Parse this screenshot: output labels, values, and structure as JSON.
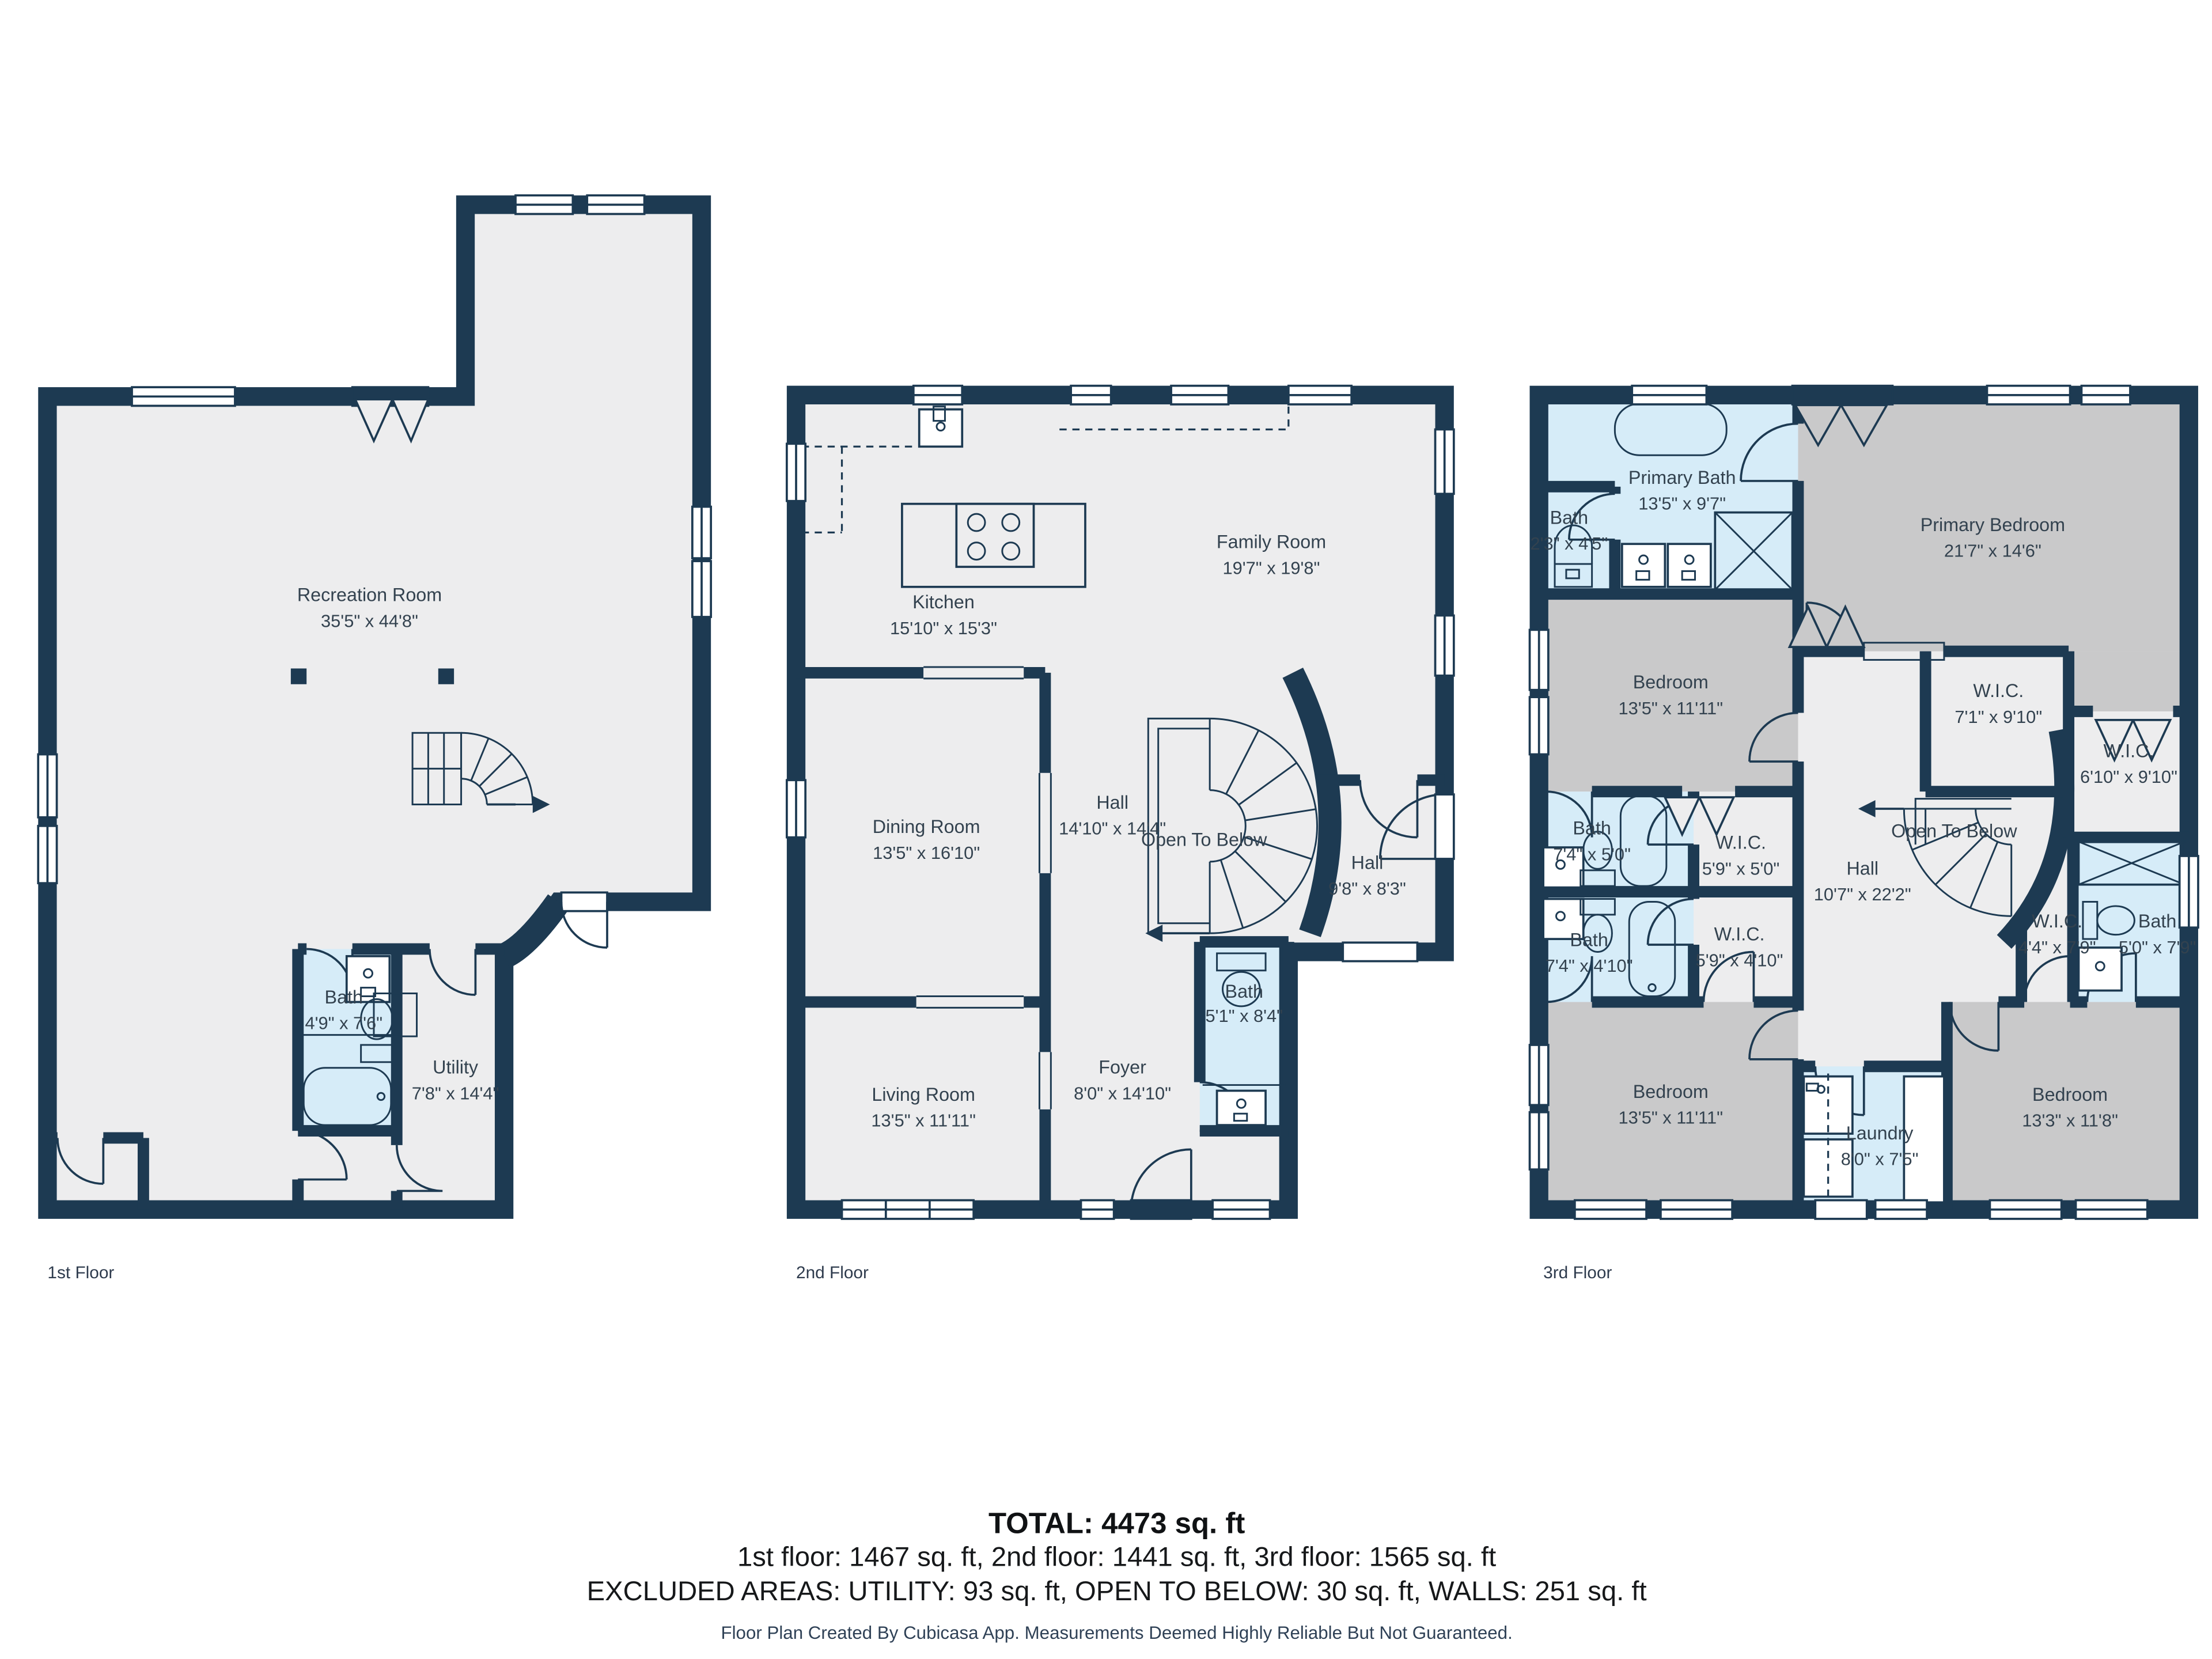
{
  "colors": {
    "wall": "#1d3a52",
    "room_default": "#ededee",
    "room_bedroom": "#c9c9ca",
    "room_wet": "#d6ecf8",
    "label_text": "#33424f",
    "background": "#ffffff"
  },
  "floors": [
    {
      "label": "1st Floor",
      "rooms": [
        {
          "name": "Recreation Room",
          "dims": "35'5\" x 44'8\""
        },
        {
          "name": "Bath",
          "dims": "4'9\" x 7'6\""
        },
        {
          "name": "Utility",
          "dims": "7'8\" x 14'4\""
        }
      ]
    },
    {
      "label": "2nd Floor",
      "rooms": [
        {
          "name": "Kitchen",
          "dims": "15'10\" x 15'3\""
        },
        {
          "name": "Family Room",
          "dims": "19'7\" x 19'8\""
        },
        {
          "name": "Dining Room",
          "dims": "13'5\" x 16'10\""
        },
        {
          "name": "Hall",
          "dims": "14'10\" x 14'4\""
        },
        {
          "name": "Open To Below",
          "dims": ""
        },
        {
          "name": "Hall",
          "dims": "9'8\" x 8'3\""
        },
        {
          "name": "Bath",
          "dims": "5'1\" x 8'4\""
        },
        {
          "name": "Foyer",
          "dims": "8'0\" x 14'10\""
        },
        {
          "name": "Living Room",
          "dims": "13'5\" x 11'11\""
        }
      ]
    },
    {
      "label": "3rd Floor",
      "rooms": [
        {
          "name": "Primary Bath",
          "dims": "13'5\" x 9'7\""
        },
        {
          "name": "Bath",
          "dims": "2'3\" x 4'5\""
        },
        {
          "name": "Primary Bedroom",
          "dims": "21'7\" x 14'6\""
        },
        {
          "name": "Bedroom",
          "dims": "13'5\" x 11'11\""
        },
        {
          "name": "W.I.C.",
          "dims": "7'1\" x 9'10\""
        },
        {
          "name": "W.I.C.",
          "dims": "6'10\" x 9'10\""
        },
        {
          "name": "Bath",
          "dims": "7'4\" x 5'0\""
        },
        {
          "name": "W.I.C.",
          "dims": "5'9\" x 5'0\""
        },
        {
          "name": "Bath",
          "dims": "7'4\" x 4'10\""
        },
        {
          "name": "W.I.C.",
          "dims": "5'9\" x 4'10\""
        },
        {
          "name": "Hall",
          "dims": "10'7\" x 22'2\""
        },
        {
          "name": "Open To Below",
          "dims": ""
        },
        {
          "name": "W.I.C.",
          "dims": "4'4\" x 7'9\""
        },
        {
          "name": "Bath",
          "dims": "5'0\" x 7'9\""
        },
        {
          "name": "Bedroom",
          "dims": "13'5\" x 11'11\""
        },
        {
          "name": "Laundry",
          "dims": "8'0\" x 7'5\""
        },
        {
          "name": "Bedroom",
          "dims": "13'3\" x 11'8\""
        }
      ]
    }
  ],
  "summary": {
    "total": "TOTAL: 4473 sq. ft",
    "floors_line": "1st floor: 1467 sq. ft, 2nd floor: 1441 sq. ft, 3rd floor: 1565 sq. ft",
    "excluded_line": "EXCLUDED AREAS: UTILITY: 93 sq. ft, OPEN TO BELOW: 30 sq. ft, WALLS: 251 sq. ft",
    "disclaimer": "Floor Plan Created By Cubicasa App. Measurements Deemed Highly Reliable But Not Guaranteed."
  }
}
